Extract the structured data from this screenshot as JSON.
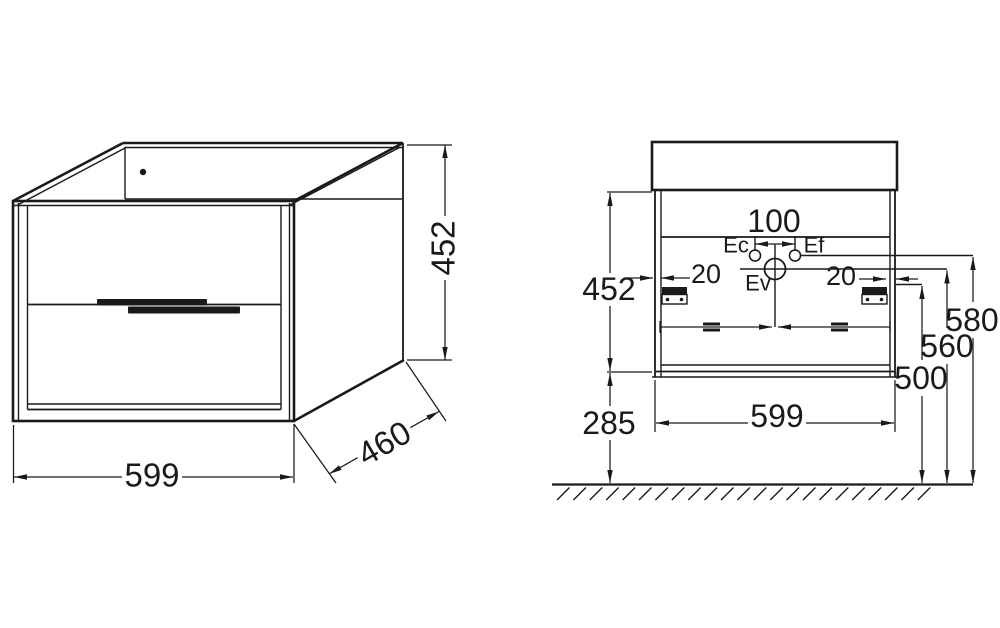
{
  "drawing": {
    "background_color": "#ffffff",
    "line_color": "#1a1a1a",
    "isometric_view": {
      "width_label": "599",
      "depth_label": "460",
      "height_label": "452"
    },
    "rear_view": {
      "height_label": "452",
      "ground_clearance_label": "285",
      "width_label": "599",
      "hole_spacing_label": "100",
      "offset_left_label": "20",
      "offset_right_label": "20",
      "tap_line_height_label": "580",
      "waste_line_height_label": "560",
      "bracket_height_label": "500",
      "ec_label": "Ec",
      "ef_label": "Ef",
      "ev_label": "Ev"
    }
  }
}
